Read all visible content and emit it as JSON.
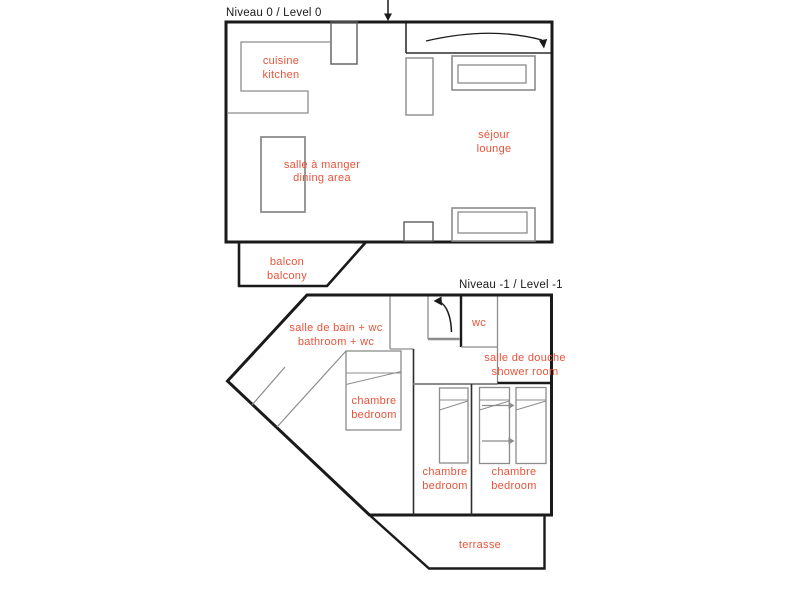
{
  "colors": {
    "label": "#e8533a",
    "wall": "#1a1a1a",
    "furniture": "#8c8c8c"
  },
  "levels": [
    {
      "id": "level-0",
      "title": "Niveau 0 / Level 0",
      "rooms": [
        {
          "id": "kitchen",
          "fr": "cuisine",
          "en": "kitchen"
        },
        {
          "id": "dining-area",
          "fr": "salle à manger",
          "en": "dining area"
        },
        {
          "id": "lounge",
          "fr": "séjour",
          "en": "lounge"
        },
        {
          "id": "balcony",
          "fr": "balcon",
          "en": "balcony"
        }
      ]
    },
    {
      "id": "level-minus-1",
      "title": "Niveau -1 / Level -1",
      "rooms": [
        {
          "id": "bathroom",
          "fr": "salle de bain + wc",
          "en": "bathroom + wc"
        },
        {
          "id": "wc",
          "fr": "wc",
          "en": ""
        },
        {
          "id": "shower-room",
          "fr": "salle de douche",
          "en": "shower room"
        },
        {
          "id": "bedroom-main",
          "fr": "chambre",
          "en": "bedroom"
        },
        {
          "id": "bedroom-middle",
          "fr": "chambre",
          "en": "bedroom"
        },
        {
          "id": "bedroom-right",
          "fr": "chambre",
          "en": "bedroom"
        },
        {
          "id": "terrace",
          "fr": "terrasse",
          "en": ""
        }
      ]
    }
  ]
}
